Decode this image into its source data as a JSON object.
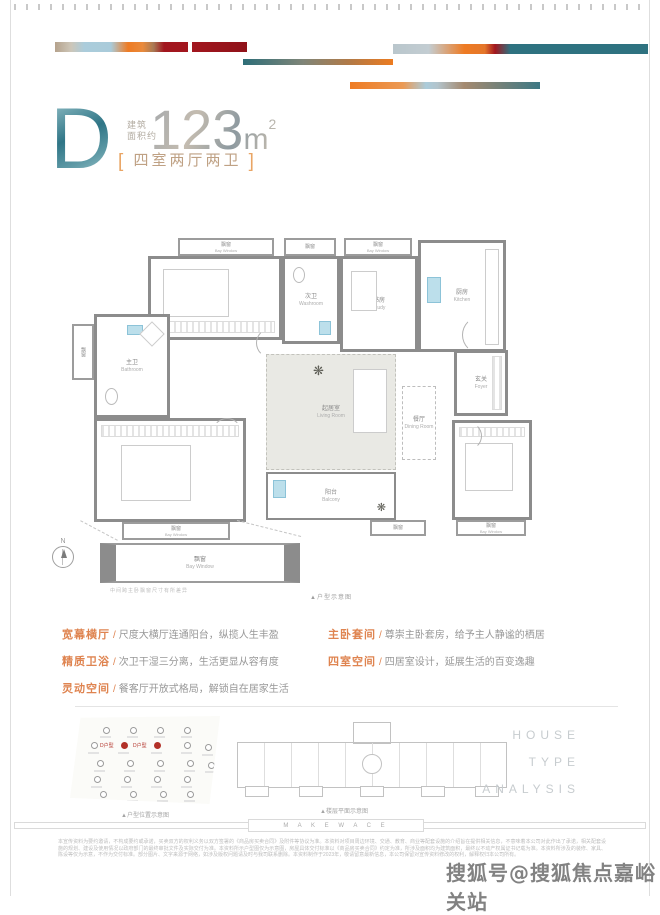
{
  "header": {
    "unit_letter": "D",
    "area_label_l1": "建筑",
    "area_label_l2": "面积约",
    "area_value": "123",
    "area_unit": "m",
    "area_exp": "2",
    "bracket_left": "[",
    "bracket_right": "]",
    "layout_text": "四室两厅两卫"
  },
  "floorplan": {
    "caption": "▲户型示意图",
    "bay_note": "中间跨主卧飘窗尺寸有所差异",
    "compass_n": "N",
    "baywindow": {
      "cn": "飘窗",
      "en": "Bay Window"
    },
    "rooms": {
      "bedroom_tl": {
        "cn": "次卧",
        "en": "Bedroom"
      },
      "washroom": {
        "cn": "次卫",
        "en": "Washroom"
      },
      "study": {
        "cn": "书房",
        "en": "Study"
      },
      "kitchen": {
        "cn": "厨房",
        "en": "Kitchen"
      },
      "bathroom": {
        "cn": "主卫",
        "en": "Bathroom"
      },
      "master_bedroom": {
        "cn": "主卧",
        "en": "Master Bedroom"
      },
      "living": {
        "cn": "起居室",
        "en": "Living Room"
      },
      "dining": {
        "cn": "餐厅",
        "en": "Dining Room"
      },
      "foyer": {
        "cn": "玄关",
        "en": "Foyer"
      },
      "balcony": {
        "cn": "阳台",
        "en": "Balcony"
      },
      "bedroom_br": {
        "cn": "次卧",
        "en": "Bedroom"
      }
    }
  },
  "features": {
    "left": [
      {
        "title": "宽幕横厅",
        "sep": "/",
        "desc": "尺度大横厅连通阳台，纵揽人生丰盈"
      },
      {
        "title": "精质卫浴",
        "sep": "/",
        "desc": "次卫干湿三分离，生活更显从容有度"
      },
      {
        "title": "灵动空间",
        "sep": "/",
        "desc": "餐客厅开放式格局，解锁自在居家生活"
      }
    ],
    "right": [
      {
        "title": "主卧套间",
        "sep": "/",
        "desc": "尊崇主卧套房，给予主人静谧的栖居"
      },
      {
        "title": "四室空间",
        "sep": "/",
        "desc": "四居室设计，延展生活的百变逸趣"
      }
    ]
  },
  "bottom": {
    "site_caption": "▲户型位置示意图",
    "plate_caption": "▲楼层平面示意图",
    "analysis_lines": [
      "HOUSE",
      "TYPE",
      "ANALYSIS"
    ],
    "red_marker_label": "D户型",
    "site_markers": [
      {
        "x": 22,
        "y": 12,
        "red": false
      },
      {
        "x": 40,
        "y": 12,
        "red": false
      },
      {
        "x": 58,
        "y": 12,
        "red": false
      },
      {
        "x": 76,
        "y": 12,
        "red": false
      },
      {
        "x": 14,
        "y": 30,
        "red": false
      },
      {
        "x": 34,
        "y": 30,
        "red": true
      },
      {
        "x": 56,
        "y": 30,
        "red": true
      },
      {
        "x": 76,
        "y": 30,
        "red": false
      },
      {
        "x": 90,
        "y": 32,
        "red": false
      },
      {
        "x": 18,
        "y": 50,
        "red": false
      },
      {
        "x": 38,
        "y": 50,
        "red": false
      },
      {
        "x": 58,
        "y": 50,
        "red": false
      },
      {
        "x": 78,
        "y": 50,
        "red": false
      },
      {
        "x": 92,
        "y": 52,
        "red": false
      },
      {
        "x": 16,
        "y": 68,
        "red": false
      },
      {
        "x": 36,
        "y": 68,
        "red": false
      },
      {
        "x": 56,
        "y": 68,
        "red": false
      },
      {
        "x": 76,
        "y": 68,
        "red": false
      },
      {
        "x": 20,
        "y": 85,
        "red": false
      },
      {
        "x": 40,
        "y": 85,
        "red": false
      },
      {
        "x": 60,
        "y": 85,
        "red": false
      },
      {
        "x": 78,
        "y": 85,
        "red": false
      }
    ]
  },
  "footer": {
    "brand_text": "M A K E  W A C E",
    "disclaimer": "本宣传资料为要约邀请，不构成要约或承诺，买卖双方的权利义务以双方签署的《商品房买卖合同》及附件等协议为准。本资料对项目周边环境、交通、教育、商业等配套设施的介绍旨在提供相关信息，不意味着本公司对此作出了承诺，相关配套设施的规划、建设及使用情况以政府部门的最终审批文件及实际交付为准。本资料所示户型图仅为示意图，房屋具体交付标准以《商品房买卖合同》约定为准，所涉及面积均为建筑面积，最终以不动产权属证书记载为准。本资料所涉及的装修、家具、陈设等仅为示意，不作为交付标准。部分图片、文字来源于网络，如涉及版权问题请及时与我司联系删除。本资料制作于2023年，敬请留意最新信息，本公司保留对宣传资料修改的权利，解释权归本公司所有。",
    "watermark": "搜狐号@搜狐焦点嘉峪关站"
  },
  "colors": {
    "teal": "#2e7280",
    "orange": "#ee7b23",
    "crimson": "#a2161e",
    "tan": "#b5a28c",
    "light_blue": "#abccdb",
    "feature_title": "#df8450",
    "red_marker": "#b23128"
  }
}
